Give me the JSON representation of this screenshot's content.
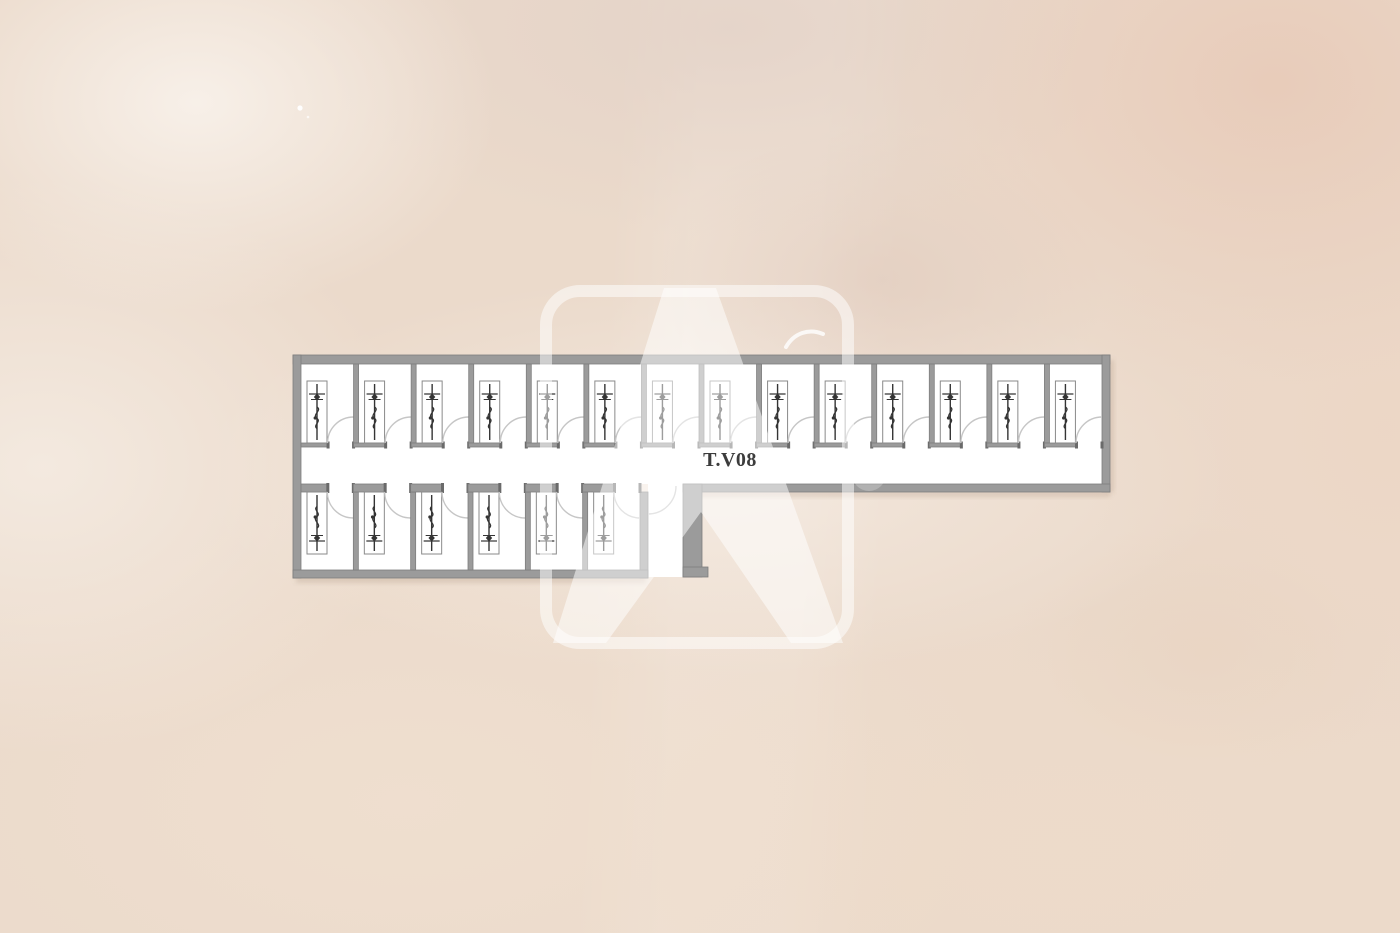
{
  "scene": {
    "description": "Architectural floor plan of a modular unit block on a beige watercolor background with a translucent letter-A logo watermark",
    "background_base": "#ebdacb"
  },
  "plan": {
    "corridor_label": "T.V08",
    "top_row_rooms": 14,
    "bottom_row_rooms": 6,
    "icons": {
      "unit_fixture": "plumbing-stack-icon",
      "door_swing": "door-swing-arc-icon"
    },
    "colors": {
      "wall": "#9b9b9b",
      "wall_edge": "#7e7e7e",
      "jamb": "#6a6a6a",
      "room_fill": "#ffffff",
      "fixture_outline": "#8a8a8a",
      "fixture_line": "#343434",
      "door_arc": "#c6c6c6",
      "label_text": "#3c3c3c",
      "shadow": "rgba(140,110,88,0.20)"
    }
  },
  "watermark": {
    "icon": "letter-a-logo-watermark-icon",
    "color": "rgba(255,255,255,0.52)",
    "accent": "rgba(255,255,255,0.8)"
  }
}
